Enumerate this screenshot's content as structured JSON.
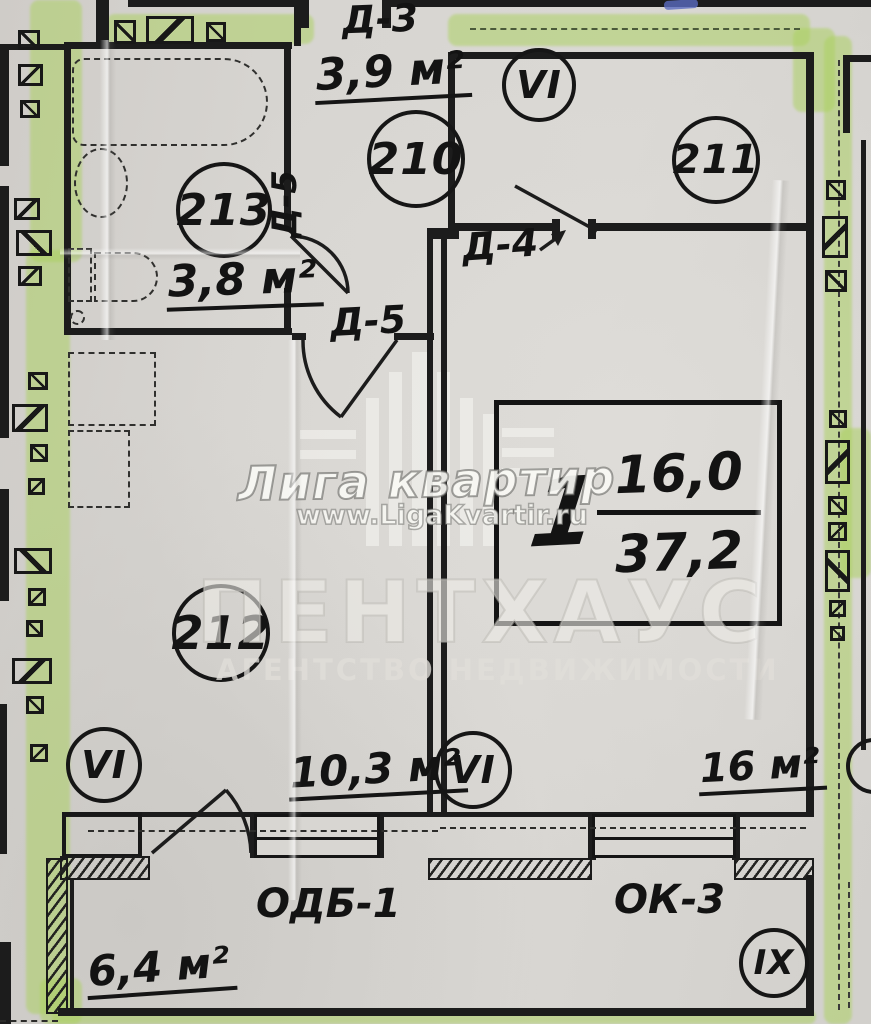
{
  "watermark": {
    "brand": "Лига квартир",
    "site": "www.LigaKvartir.ru",
    "agency": "ПЕНТХАУС",
    "agency_type": "АГЕНТСТВО НЕДВИЖИМОСТИ"
  },
  "apartment": {
    "number": "1",
    "living_area": "16,0",
    "total_area": "37,2"
  },
  "rooms": {
    "hall": {
      "number": "210",
      "area": "3,9 м²"
    },
    "bathroom": {
      "number": "213",
      "area": "3,8 м²"
    },
    "adjacent": {
      "number": "211"
    },
    "kitchen": {
      "number": "212",
      "area": "10,3 м²"
    },
    "living": {
      "area": "16 м²"
    },
    "balcony": {
      "area": "6,4 м²"
    }
  },
  "doors": {
    "d3": "Д-3",
    "d4": "Д-4",
    "d5": "Д-5"
  },
  "openings": {
    "balcony_door_unit": "ОДБ-1",
    "window_unit": "ОК-3"
  },
  "stamps": {
    "vi": "VI",
    "ix": "IX"
  },
  "colors": {
    "highlighter": "#abd15f",
    "ink": "#1c1c1c",
    "paper": "#d6d3cf"
  }
}
